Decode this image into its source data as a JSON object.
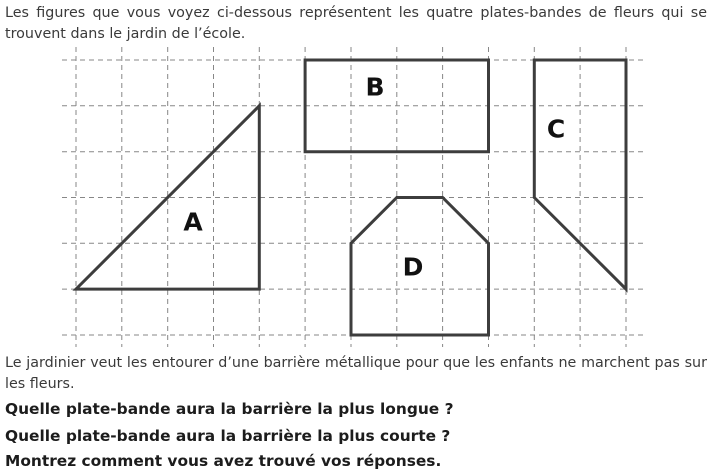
{
  "intro": {
    "text": "Les figures que vous voyez ci-dessous représentent les quatre plates-bandes de fleurs qui se trouvent dans le jardin de l’école."
  },
  "figure": {
    "description": "four flower beds drawn on a dashed square grid",
    "grid": {
      "unit": 45.83,
      "origin_x": 76,
      "origin_y": 60,
      "cols": 13,
      "rows": 7,
      "left": 62,
      "right": 646,
      "top": 47,
      "bottom": 347,
      "line_color": "#878787",
      "dash_pattern": "5 4"
    },
    "shape_stroke_color": "#3d3d3d",
    "label_color": "#111111",
    "shapes": [
      {
        "label": "A",
        "type": "right-triangle",
        "points_units": [
          [
            0,
            5
          ],
          [
            4,
            5
          ],
          [
            4,
            1
          ]
        ],
        "label_pos_px": [
          193,
          222
        ]
      },
      {
        "label": "B",
        "type": "rectangle",
        "points_units": [
          [
            5,
            0
          ],
          [
            9,
            0
          ],
          [
            9,
            2
          ],
          [
            5,
            2
          ]
        ],
        "label_pos_px": [
          375,
          87
        ]
      },
      {
        "label": "C",
        "type": "quadrilateral",
        "points_units": [
          [
            10,
            0
          ],
          [
            12,
            0
          ],
          [
            12,
            5
          ],
          [
            10,
            3
          ]
        ],
        "label_pos_px": [
          556,
          129
        ]
      },
      {
        "label": "D",
        "type": "hexagon",
        "points_units": [
          [
            6,
            6
          ],
          [
            6,
            4
          ],
          [
            7,
            3
          ],
          [
            8,
            3
          ],
          [
            9,
            4
          ],
          [
            9,
            6
          ]
        ],
        "label_pos_px": [
          413,
          267
        ]
      }
    ]
  },
  "body": {
    "text": "Le jardinier veut les entourer d’une barrière métallique pour que les enfants ne marchent pas sur les fleurs."
  },
  "questions": [
    {
      "text": "Quelle plate-bande aura la barrière la plus longue ?"
    },
    {
      "text": "Quelle plate-bande aura la barrière la plus courte ?"
    },
    {
      "text": "Montrez comment vous avez trouvé vos réponses."
    }
  ]
}
